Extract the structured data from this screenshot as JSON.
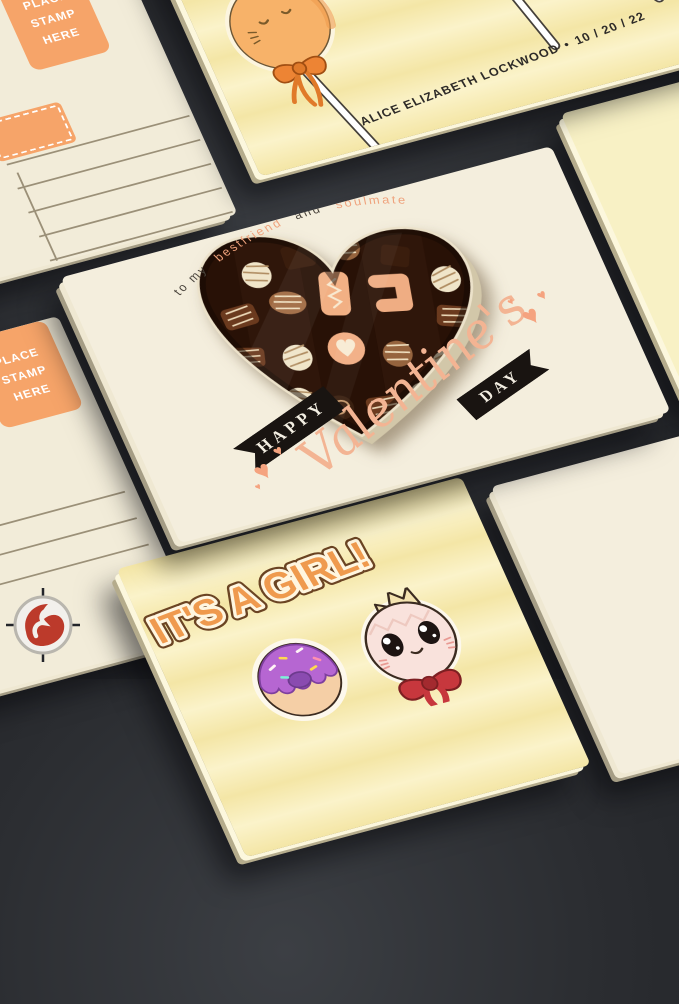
{
  "background": {
    "color": "#2b2d31"
  },
  "brand_logo": {
    "symbol": "S"
  },
  "postcard_top_left": {
    "stamp_box": [
      "PLACE",
      "STAMP",
      "HERE"
    ]
  },
  "postcard_mid_left": {
    "stamp_box": [
      "PLACE",
      "STAMP",
      "HERE"
    ]
  },
  "top_card": {
    "name": "ALICE ELIZABETH LOCKWOOD",
    "bullet": "•",
    "date": "10 / 20 / 22"
  },
  "main_card": {
    "dedication": {
      "part1": "to my",
      "part2": "bestfriend",
      "part3": "and",
      "part4": "soulmate"
    },
    "banner_happy": "HAPPY",
    "script_word": "Valentine's",
    "banner_day": "DAY"
  },
  "bottom_card": {
    "headline": "IT'S A GIRL!"
  },
  "colors": {
    "accent_orange": "#f6a469",
    "banner_black": "#191411",
    "script_peach": "#f3b493",
    "dedication_dark": "#4a443c",
    "dedication_orange": "#efa27c",
    "headline_orange": "#ef9a4e",
    "card_cream": "#f4eedd",
    "card_pale_yellow": "#f8f1c5",
    "chocolate_box_brown": "#2b150b"
  }
}
